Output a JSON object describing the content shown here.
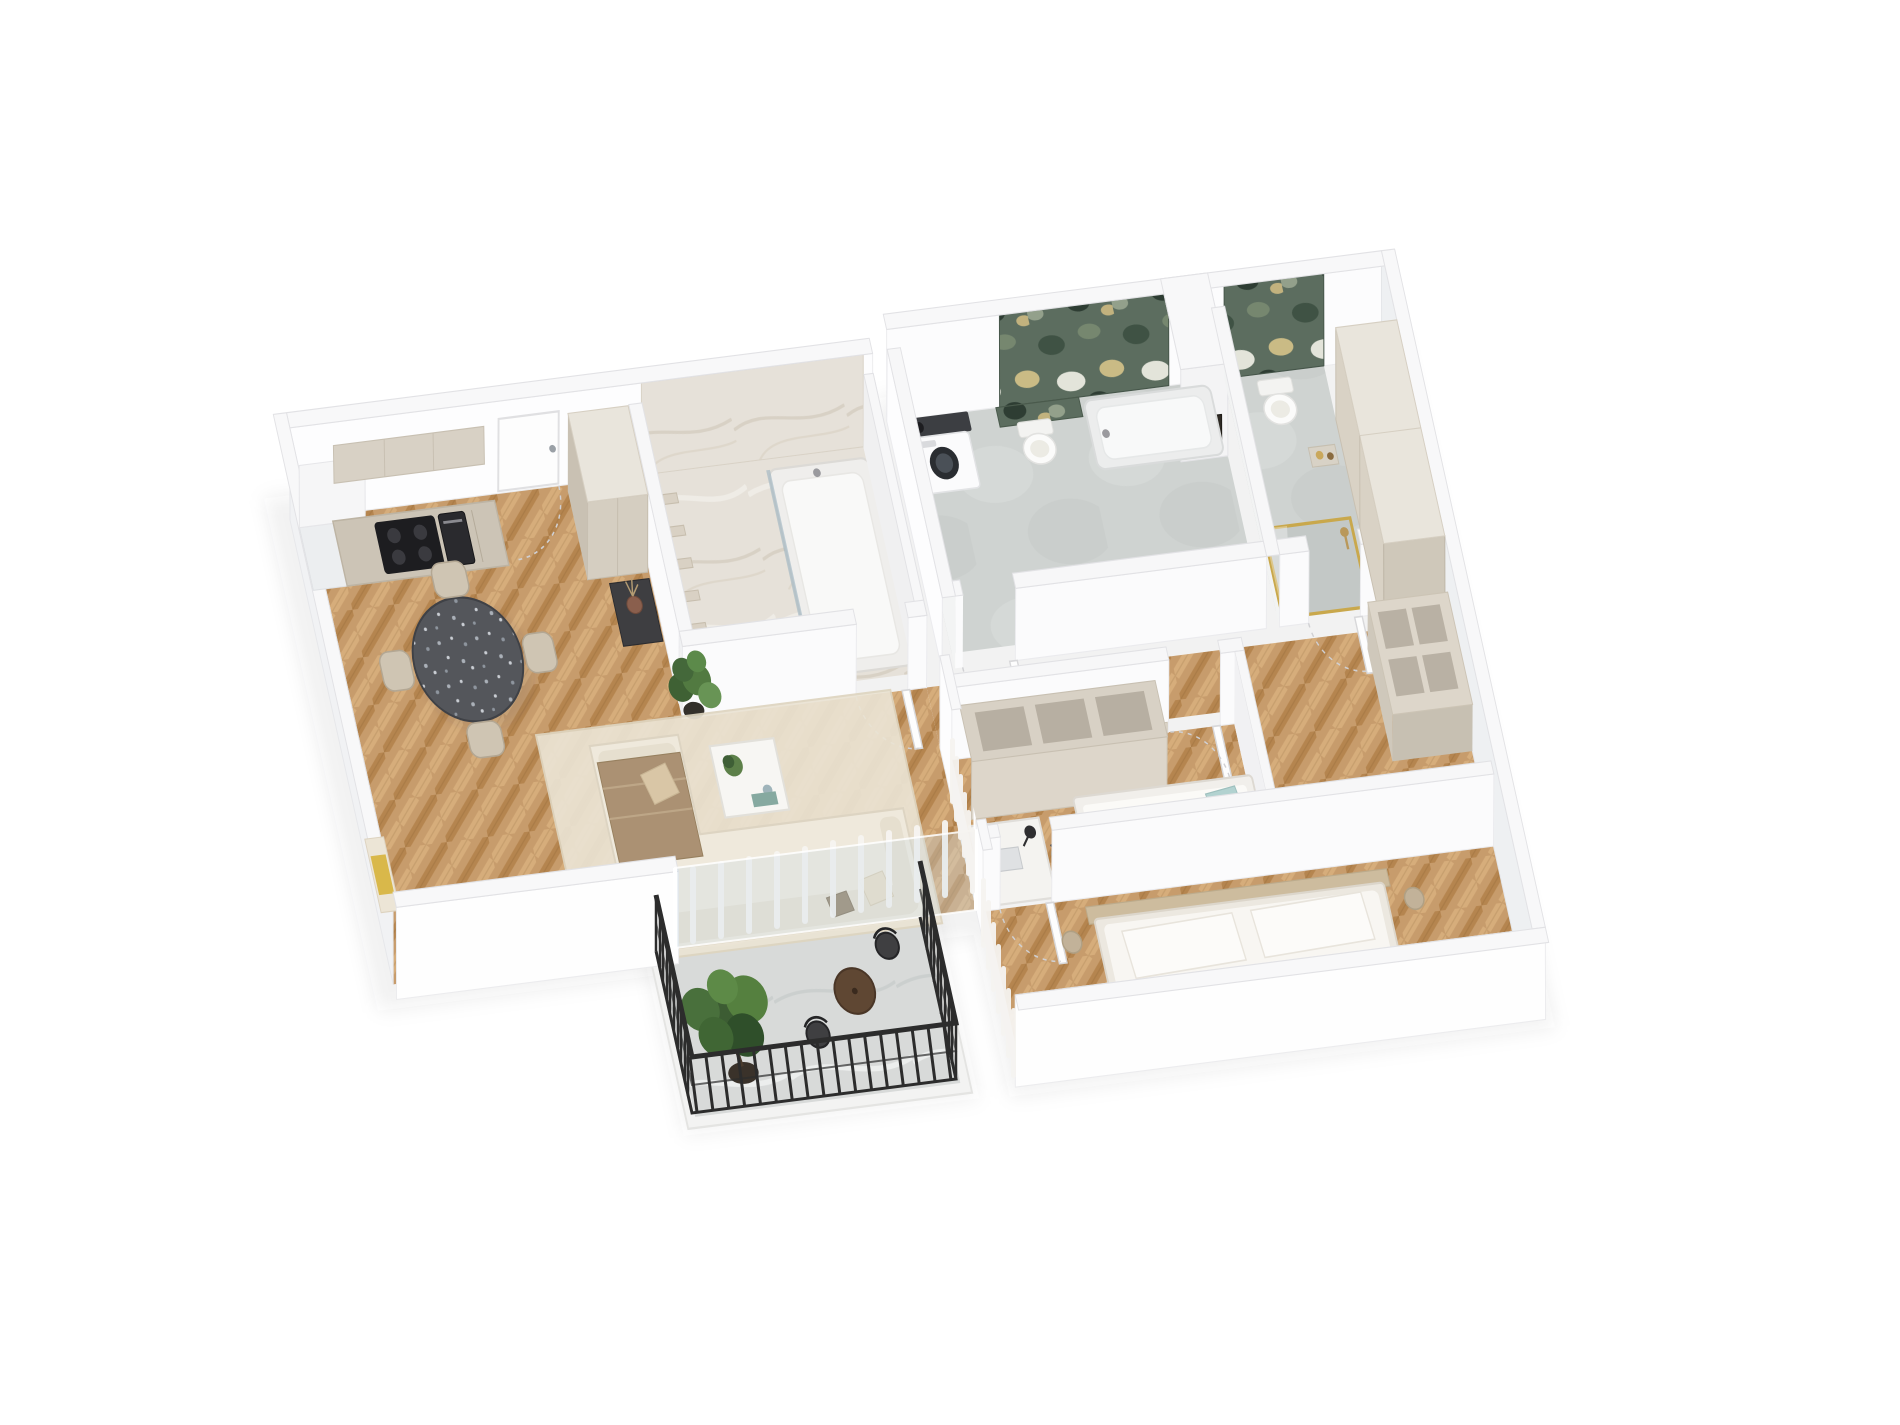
{
  "meta": {
    "title": "3D isometric floor plan render of a two-bedroom apartment",
    "render_style": "isometric-3d-floor-plan",
    "background": "#ffffff",
    "visible_text": "none"
  },
  "palette": {
    "wall_top": "#f8f8f9",
    "wall_face_white": "#fdfdfe",
    "wall_face_shade": "#eef0f2",
    "wood_floor": "#c79c6c",
    "wood_dark": "#b5854f",
    "wood_light": "#d6ad7b",
    "marble_beige": "#e6e1d9",
    "marble_green": "#5c6d5f",
    "marble_green_dark": "#3f5244",
    "gold_accent": "#c9a84c",
    "concrete_floor": "#cfd3d1",
    "balcony_stone": "#d8dad9",
    "sofa_cream": "#efe9dc",
    "throw_brown": "#ab9173",
    "rug_cream": "#ebe4d4",
    "table_terrazzo": "#54565b",
    "chair_beige": "#cfc5b3",
    "cabinet_beige": "#d6cfc2",
    "counter_dark": "#3a3a3c",
    "appliance_black": "#1d1d20",
    "teal_bedding": "#9cc5c3",
    "chair_blue": "#8fb8c9",
    "plant_green": "#4e7040",
    "pot_dark": "#3a322a",
    "vase_terracotta": "#8a5f4d",
    "railing_black": "#2c2c2c",
    "bed_white": "#f8f6f2",
    "headboard_wood": "#cdbc9e",
    "throw_yellow": "#d9b84a"
  },
  "scene": {
    "rooms": [
      {
        "id": "kitchen-living",
        "label": "Open kitchen / living room",
        "floor": "herringbone oak",
        "furniture": [
          "kitchen base cabinets",
          "induction cooktop",
          "built-in oven",
          "upper cabinets",
          "entrance door",
          "tall hallway wardrobe",
          "console with terracotta vase",
          "monstera plant",
          "round terrazzo dining table",
          "4 dining chairs",
          "corner sofa with brown throw and pillows",
          "white coffee table with plant",
          "cream area rug",
          "bench with yellow throw",
          "leaning art frame",
          "glass wall with sheer curtains to balcony"
        ]
      },
      {
        "id": "balcony",
        "label": "Balcony",
        "floor": "stone tiles",
        "furniture": [
          "black metal railing",
          "potted tree",
          "round bistro table",
          "2 black bistro chairs"
        ]
      },
      {
        "id": "bathroom-1",
        "label": "Main bathroom (beige marble)",
        "floor": "beige marble",
        "furniture": [
          "stepped niche shelves",
          "walk-in bathtub shower with glass screen",
          "wall-hung toilet",
          "marble feature wall",
          "white interior door"
        ]
      },
      {
        "id": "hallway",
        "label": "Hallway",
        "floor": "herringbone oak",
        "furniture": []
      },
      {
        "id": "bathroom-2",
        "label": "Laundry bathroom (green marble)",
        "floor": "concrete tiles",
        "furniture": [
          "washing machine with dark countertop sink",
          "wall-hung toilet",
          "bathtub",
          "green exotic marble feature wall",
          "white interior door"
        ]
      },
      {
        "id": "shower-room",
        "label": "Shower room / WC",
        "floor": "concrete tiles",
        "furniture": [
          "wall-hung toilet",
          "walk-in shower with gold framed glass",
          "shelf with toiletries",
          "green marble accent wall",
          "small framed artwork",
          "white interior door"
        ]
      },
      {
        "id": "child-room",
        "label": "Child room / study",
        "floor": "herringbone oak",
        "furniture": [
          "open cubby wardrobe",
          "white desk with lamp and laptop",
          "blue office chair",
          "single bed with teal bedding",
          "plush bunny",
          "window with sheer curtains",
          "white interior door"
        ]
      },
      {
        "id": "bedroom",
        "label": "Bedroom",
        "floor": "herringbone oak",
        "furniture": [
          "double bed with white duvet and pillows",
          "wood headboard",
          "beige throw",
          "tall beige wardrobe",
          "open shelf unit",
          "window with sheer curtains",
          "white interior door"
        ]
      }
    ],
    "counts": {
      "rooms": 8,
      "doors": 6,
      "toilets": 3,
      "bathtubs": 2,
      "beds": 2,
      "plants": 3,
      "dining_chairs": 4
    }
  }
}
